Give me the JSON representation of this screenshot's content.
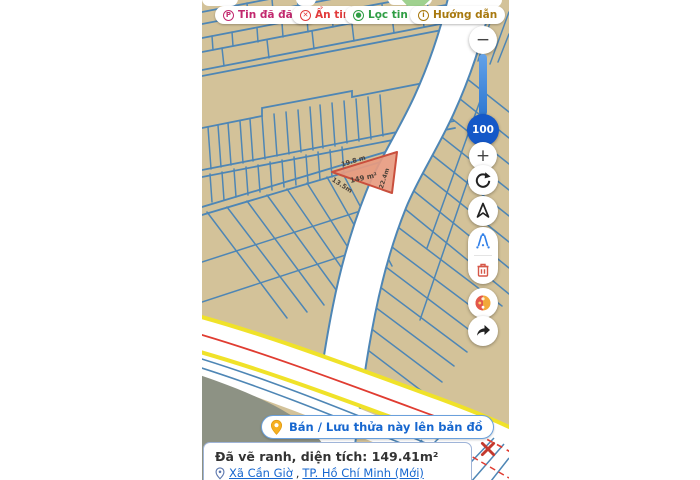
{
  "toolbar": {
    "buttons": [
      {
        "id": "tin-da-dang",
        "label": "Tin đã đăng",
        "color": "#c2286e",
        "icon": "P"
      },
      {
        "id": "an-tin",
        "label": "Ẩn tin",
        "color": "#e23b3b",
        "icon": "✕"
      },
      {
        "id": "loc-tin",
        "label": "Lọc tin",
        "color": "#2f9e44",
        "icon": "●",
        "chevron": "∨"
      },
      {
        "id": "huong-dan",
        "label": "Hướng dẫn",
        "color": "#a8790f",
        "icon": "i"
      }
    ]
  },
  "zoom_controls": {
    "minus": "−",
    "plus": "+",
    "level": "100"
  },
  "map": {
    "highlighted_parcel": {
      "area_label": "149 m²",
      "edge_top": "19.8 m",
      "edge_left": "13.5m",
      "edge_right": "22.4m"
    },
    "colors": {
      "parcel_fill": "#d3c299",
      "parcel_line": "#4e86b5",
      "highlight_fill": "#e79b80",
      "highlight_stroke": "#c94f3d",
      "road_yellow": "#f0e229",
      "road_red": "#e03c31",
      "water_gray": "#8d9284",
      "accent_blue": "#1767cf"
    }
  },
  "action_button": {
    "label": "Bán / Lưu thửa này lên bản đồ"
  },
  "info_panel": {
    "title": "Đã vẽ ranh, diện tích: 149.41m²",
    "location_links": [
      {
        "label": "Xã Cần Giờ"
      },
      {
        "label": "TP. Hồ Chí Minh (Mới)"
      }
    ],
    "separator": ", "
  }
}
